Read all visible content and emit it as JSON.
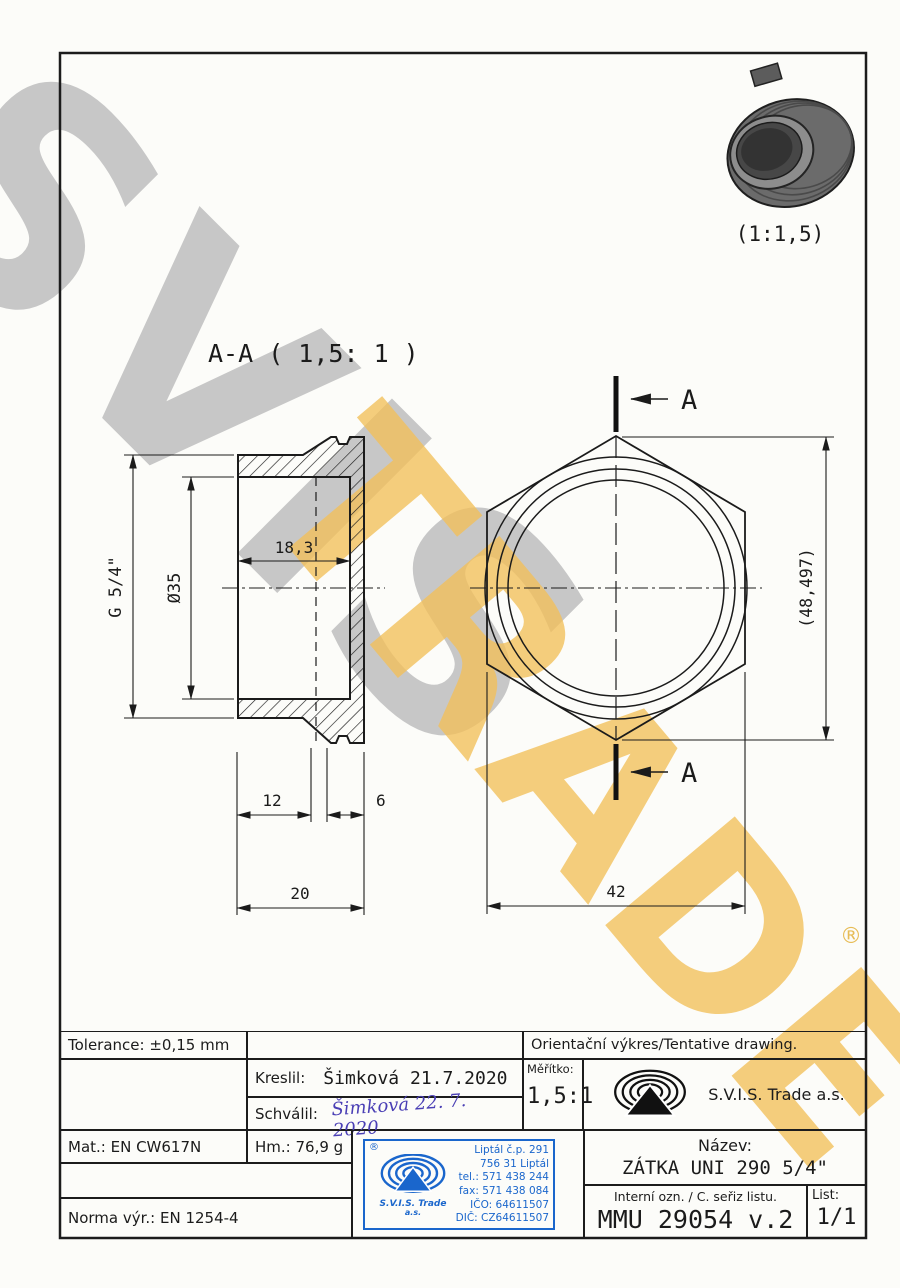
{
  "watermark": {
    "word1": "SVIS",
    "word2": "TRADE",
    "registered": "®"
  },
  "photo": {
    "scale_label": "(1:1,5)"
  },
  "section_view": {
    "title": "A-A ( 1,5: 1 )",
    "dim_thread": "G 5/4\"",
    "dim_inner_dia": "Ø35",
    "dim_depth": "18,3",
    "dim_12": "12",
    "dim_6": "6",
    "dim_20": "20"
  },
  "front_view": {
    "label_a_top": "A",
    "label_a_bottom": "A",
    "dim_across_corners": "(48,497)",
    "dim_across_flats": "42"
  },
  "title_block": {
    "tolerance": "Tolerance: ±0,15 mm",
    "orientation_note": "Orientační výkres/Tentative drawing.",
    "kreslil_label": "Kreslil:",
    "kreslil_value": "Šimková 21.7.2020",
    "schvalil_label": "Schválil:",
    "schvalil_signature": "Šimková 22. 7. 2020",
    "meritko_label": "Měřítko:",
    "meritko_value": "1,5:1",
    "company": "S.V.I.S. Trade a.s.",
    "mat": "Mat.: EN CW617N",
    "hm": "Hm.: 76,9 g",
    "norma": "Norma výr.: EN 1254-4",
    "nazev_label": "Název:",
    "nazev_value": "ZÁTKA UNI 290 5/4\"",
    "interni_label": "Interní ozn. / C. seřiz listu.",
    "interni_value": "MMU 29054 v.2",
    "list_label": "List:",
    "list_value": "1/1"
  },
  "stamp": {
    "reg": "®",
    "company_line1": "S.V.I.S. Trade",
    "company_line2": "a.s.",
    "address": [
      "Liptál č.p. 291",
      "756 31 Liptál",
      "tel.: 571 438 244",
      "fax: 571 438 084",
      "IČO: 64611507",
      "DIČ: CZ64611507"
    ]
  }
}
